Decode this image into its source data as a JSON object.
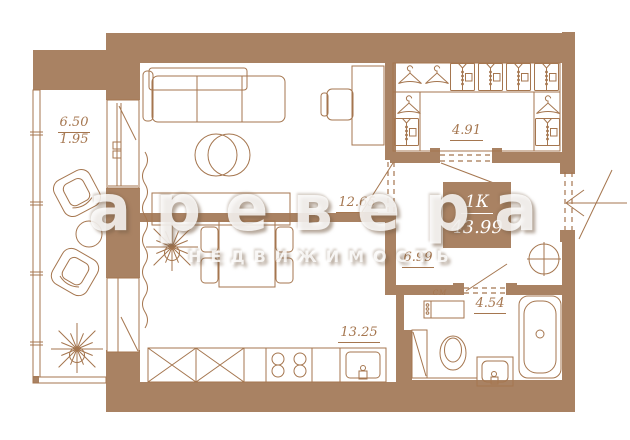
{
  "plan": {
    "apartment": {
      "type_label": "1К",
      "total_area": "43.99"
    },
    "rooms": [
      {
        "name": "balcony",
        "area": "6.50",
        "area_reduced": "1.95"
      },
      {
        "name": "living-room",
        "area": "12.65"
      },
      {
        "name": "wardrobe",
        "area": "4.91"
      },
      {
        "name": "hallway",
        "area": "6.99"
      },
      {
        "name": "kitchen",
        "area": "13.25"
      },
      {
        "name": "bathroom",
        "area": "4.54"
      }
    ],
    "labels": {
      "washing_machine": "СМ"
    },
    "watermark": {
      "brand": "аревера",
      "subtitle": "НЕДВИЖИМОСТЬ"
    },
    "colors": {
      "wall": "#a98263",
      "line": "#a5764f",
      "background": "#ffffff",
      "watermark_text": "#ffffff"
    },
    "furniture_icons": [
      "sofa",
      "coffee-tables",
      "desk",
      "desk-chair",
      "sideboard",
      "dining-table",
      "dining-chair",
      "curtain",
      "plant",
      "armchair",
      "balcony-table",
      "kitchen-counter",
      "stove",
      "kitchen-sink",
      "hanger",
      "shirt-rack",
      "washing-machine",
      "toilet",
      "washbasin",
      "bathtub",
      "ventilation-shaft",
      "entry-arrow",
      "door-swing"
    ]
  }
}
